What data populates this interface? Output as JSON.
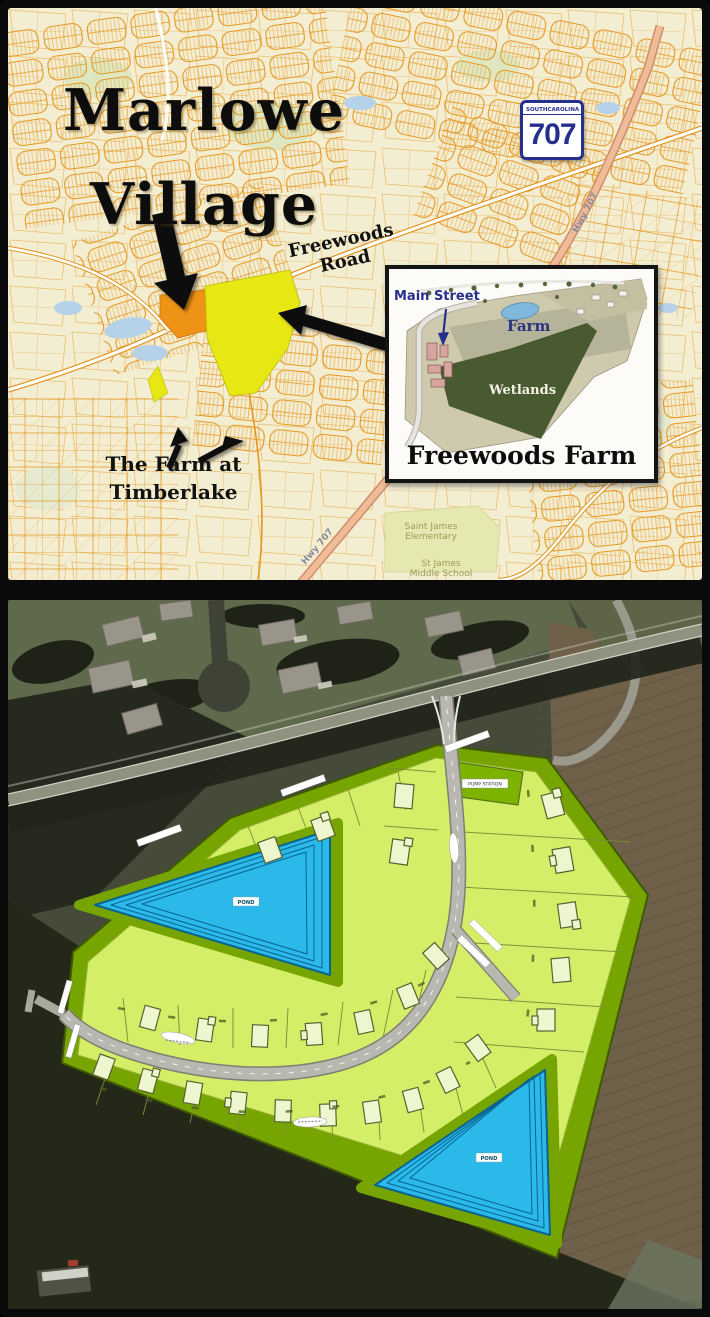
{
  "top_map": {
    "title_line1": "Marlowe",
    "title_line2": "Village",
    "freewoods_road": "Freewoods Road",
    "shield": {
      "south": "SOUTH",
      "carolina": "CAROLINA",
      "number": "707"
    },
    "hwy_label": "Hwy 707",
    "timberlake_line1": "The Farm at",
    "timberlake_line2": "Timberlake",
    "school_elementary_line1": "Saint James",
    "school_elementary_line2": "Elementary",
    "school_middle_line1": "St James",
    "school_middle_line2": "Middle School",
    "inset": {
      "main_street": "Main Street",
      "farm": "Farm",
      "wetlands": "Wetlands",
      "title": "Freewoods Farm"
    }
  },
  "site_plan": {
    "pond_upper": "POND",
    "pond_lower": "POND",
    "pump_station": "PUMP STATION"
  },
  "colors": {
    "marlowe_parcel_orange": "#ef9317",
    "freewoods_parcel_yellow": "#e6e713",
    "map_street_orange": "#e5971f",
    "map_background_cream": "#f3edd2",
    "hwy707_pink": "#f0bb97",
    "shield_navy": "#26308c",
    "plan_lot_green": "#d5ee68",
    "plan_common_olive": "#76a400",
    "pond_cyan": "#2ab9e9",
    "plan_road_gray": "#b8b8b0"
  }
}
